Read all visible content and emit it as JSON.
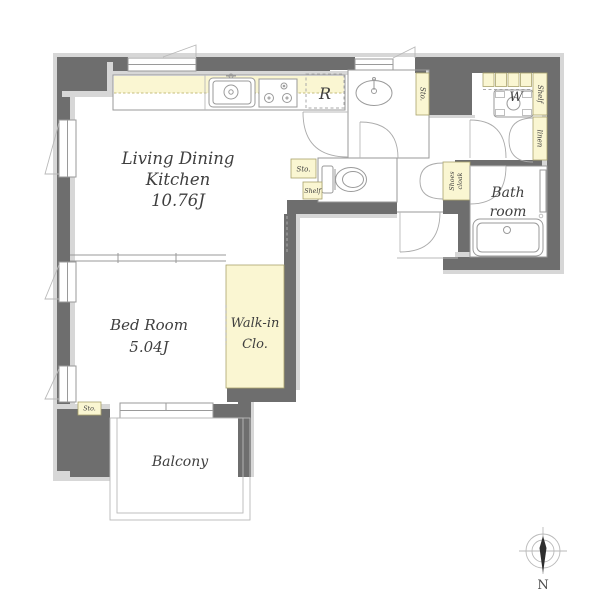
{
  "page": {
    "background": "#ffffff",
    "type": "apartment-floor-plan"
  },
  "palette": {
    "wall": "#6e6e6e",
    "wall_lining": "#d7d7d7",
    "closet_highlight": "#faf6d2",
    "outline": "#979797",
    "text": "#3f3f3f"
  },
  "rooms": {
    "ldk": {
      "lines": [
        "Living Dining",
        "Kitchen",
        "10.76J"
      ]
    },
    "bedroom": {
      "lines": [
        "Bed Room",
        "5.04J"
      ]
    },
    "walk_in_closet": {
      "lines": [
        "Walk-in",
        "Clo."
      ]
    },
    "bathroom": {
      "lines": [
        "Bath",
        "room"
      ]
    },
    "balcony": {
      "label": "Balcony"
    }
  },
  "fixtures": {
    "refrigerator_space": "R",
    "washing_machine": "W"
  },
  "storage": {
    "shelf_upper": "Shelf",
    "linen": "linen",
    "shelf_small": "Shelf",
    "sto_washroom": "Sto.",
    "sto_ldk": "Sto.",
    "sto_bedroom": "Sto.",
    "shoes_cloak": {
      "lines": [
        "Shoes",
        "cloak"
      ]
    }
  },
  "compass": {
    "north_label": "N"
  },
  "icons": {
    "kitchen_sink": "sink-with-faucet",
    "gas_stove": "three-burner-stove",
    "wash_basin": "oval-basin",
    "toilet": "toilet-bowl-with-tank",
    "bathtub": "rounded-tub",
    "washer_pan": "washing-machine-pan",
    "compass_needle": "north-needle"
  }
}
